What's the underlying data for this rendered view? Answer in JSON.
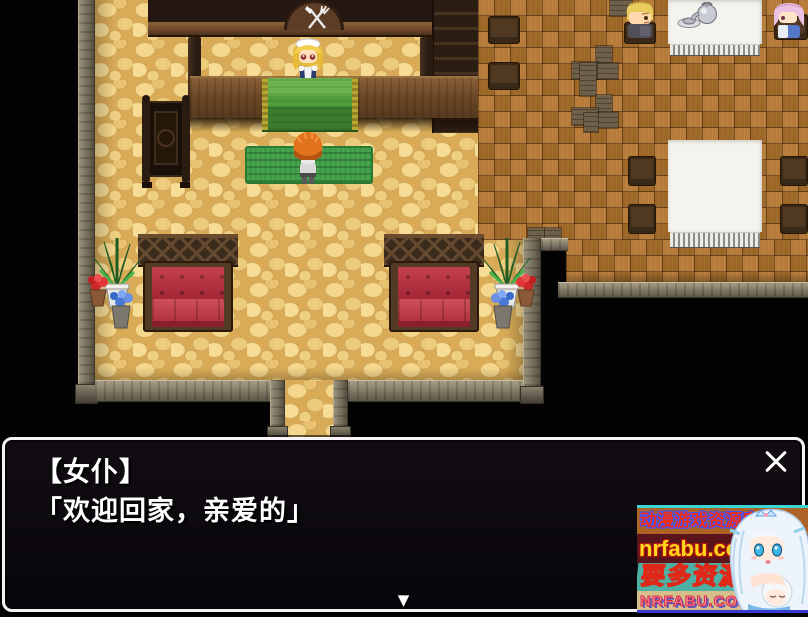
{
  "dialogue": {
    "speaker": "【女仆】",
    "line": "「欢迎回家，亲爱的」"
  },
  "icons": {
    "close": "✕",
    "continue_indicator": "▼",
    "restaurant_sign": "fork-and-knife"
  },
  "watermark": {
    "line1": "动漫游戏资源库",
    "line2": "nrfabu.com",
    "line3": "要多资源",
    "line4": "NRFABU.COM"
  },
  "scene": {
    "sprites": [
      "maid-npc",
      "player-character",
      "seated-blond-man",
      "seated-pink-haired-woman"
    ],
    "props": [
      "bar-counter",
      "green-counter-cloth",
      "green-mat",
      "wooden-screen",
      "red-sofa-left",
      "red-sofa-right",
      "potted-plants-left",
      "potted-plants-right",
      "white-table-top",
      "white-table-bottom",
      "teapot-set",
      "chairs"
    ]
  },
  "colors": {
    "dialog_background": "#0d090d",
    "dialog_border": "#f5f3f5",
    "cobble_floor": "#e8c673",
    "parquet_floor": "#b3752e",
    "sofa_red": "#c5404e",
    "cloth_green": "#4f9c3a",
    "watermark_teal": "#4db0a4",
    "watermark_tan": "#d6bf8a"
  }
}
